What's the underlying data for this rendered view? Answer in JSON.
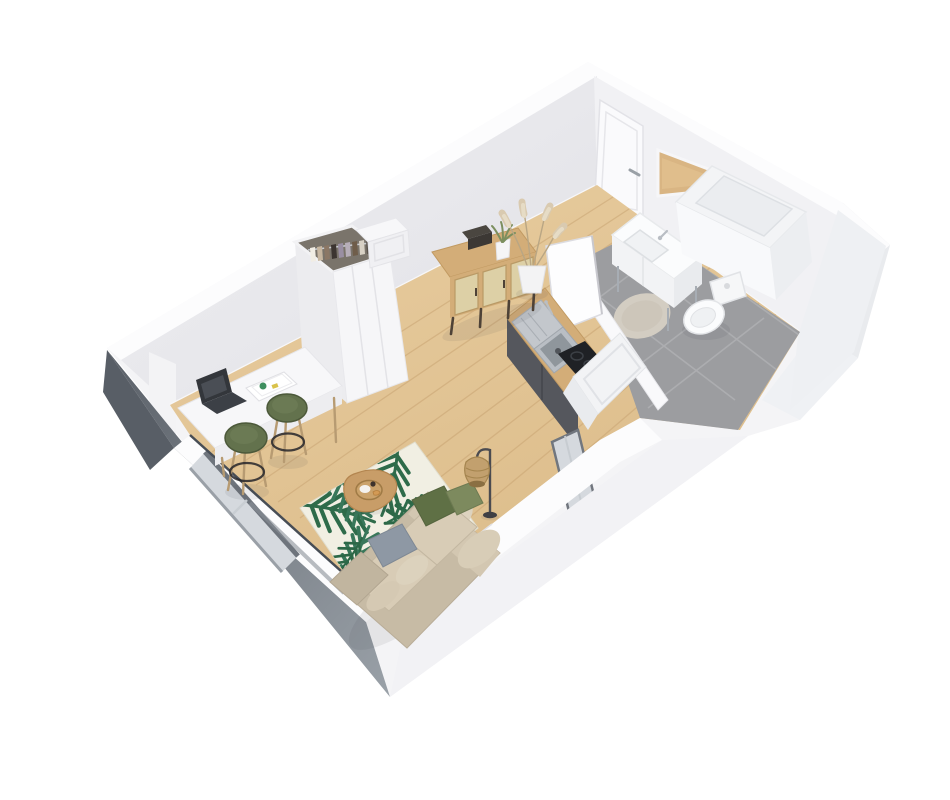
{
  "scene": {
    "type": "3d-floorplan-render",
    "description": "Isometric 3D cutaway render of a studio apartment: living area with sofa, palm-leaf rug, desk and wardrobe; kitchenette with sink and cooktop; bathroom with vanity, shower, toilet and round mat",
    "background": "#ffffff"
  },
  "rooms": [
    {
      "name": "living-area",
      "floor": "light-oak-parquet"
    },
    {
      "name": "entry",
      "floor": "light-oak-parquet"
    },
    {
      "name": "bathroom",
      "floor": "grey-tile"
    }
  ],
  "objects": [
    "entry-door",
    "wall-mirror",
    "wardrobe",
    "hanging-clothes",
    "storage-box",
    "sideboard",
    "pampas-plant",
    "potted-plant",
    "decor-box",
    "desk",
    "laptop",
    "notebooks",
    "bar-stool-left",
    "bar-stool-right",
    "palm-leaf-rug",
    "coffee-table",
    "serving-tray",
    "croissant",
    "cup",
    "sofa",
    "green-pillow",
    "sage-pillow",
    "gray-pillow",
    "floor-lamp",
    "kitchen-counter",
    "kitchen-sink",
    "kitchen-faucet",
    "cooktop",
    "base-cabinets",
    "end-cabinet",
    "window-left",
    "window-right",
    "bathroom-door-ajar",
    "vanity-sink",
    "vanity-faucet",
    "shower-enclosure",
    "toilet",
    "round-bath-mat"
  ],
  "colors": {
    "bg": "#ffffff",
    "wall_outer": "#f4f4f6",
    "wall_cut": "#fcfcfd",
    "wall_inner_left": "#e7e7eb",
    "wall_inner_right": "#f1f1f4",
    "wall_bath": "#eef0f3",
    "wall_dark": "#585e66",
    "wall_gray": "#939aa2",
    "floor_wood": "#e3c697",
    "plank_line": "#c9a473",
    "tile": "#9c9da0",
    "tile_grout": "#b0b1b3",
    "rug_cream": "#f1efe3",
    "rug_green": "#2e6b4a",
    "sofa_base": "#c7bba5",
    "sofa_cushion": "#d8ccb6",
    "sofa_light": "#ddd3bf",
    "pillow_green": "#5f7045",
    "pillow_sage": "#7d8a5e",
    "pillow_gray": "#8e98a4",
    "stool_olive": "#63724d",
    "stool_rim": "#4c593a",
    "wood": "#d3ad78",
    "wood_dark": "#b08d58",
    "cane": "#ddd0a6",
    "cabinet_dark": "#55575d",
    "steel": "#c3c7cc",
    "steel_dark": "#8f969c",
    "glass": "#d5d9de",
    "frame_gray": "#6e747c",
    "cooktop": "#1f2125",
    "door_white": "#fafafc",
    "mirror_wood": "#d9b583",
    "rattan": "#c2a06e",
    "plant_green": "#7c8f5f",
    "pampas": "#d9cab0"
  }
}
